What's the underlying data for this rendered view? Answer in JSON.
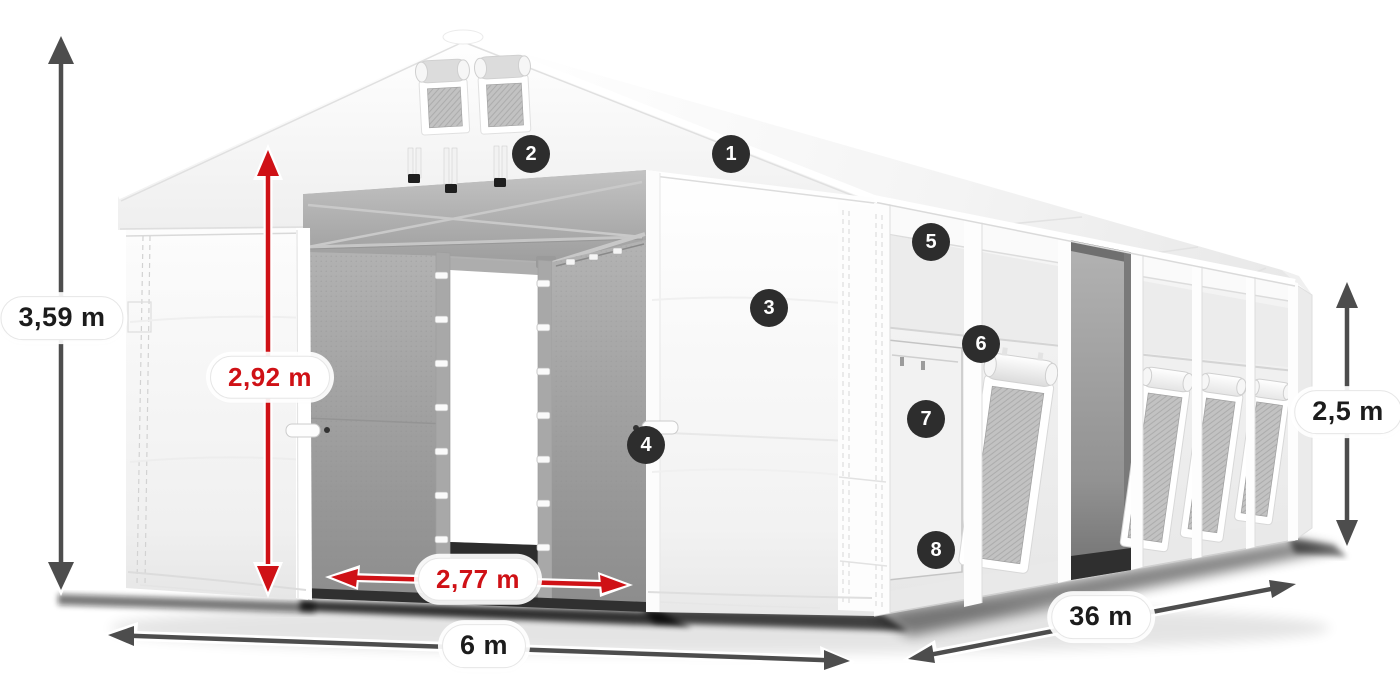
{
  "diagram": {
    "subject": "Industrial storage tent with dimension annotations",
    "view": "three-quarter front perspective"
  },
  "colors": {
    "accent_red": "#cf1116",
    "arrow_dark": "#4d4d4d",
    "badge_background": "#2d2d2d",
    "badge_text": "#ffffff",
    "label_text": "#1c1c1c",
    "pill_background": "#ffffff",
    "canvas_background": "#ffffff"
  },
  "dimensions": {
    "total_height": "3,59 m",
    "entrance_height": "2,92 m",
    "entrance_width": "2,77 m",
    "width": "6 m",
    "length": "36 m",
    "side_height": "2,5 m"
  },
  "hotspots": [
    {
      "number": "1"
    },
    {
      "number": "2"
    },
    {
      "number": "3"
    },
    {
      "number": "4"
    },
    {
      "number": "5"
    },
    {
      "number": "6"
    },
    {
      "number": "7"
    },
    {
      "number": "8"
    }
  ]
}
